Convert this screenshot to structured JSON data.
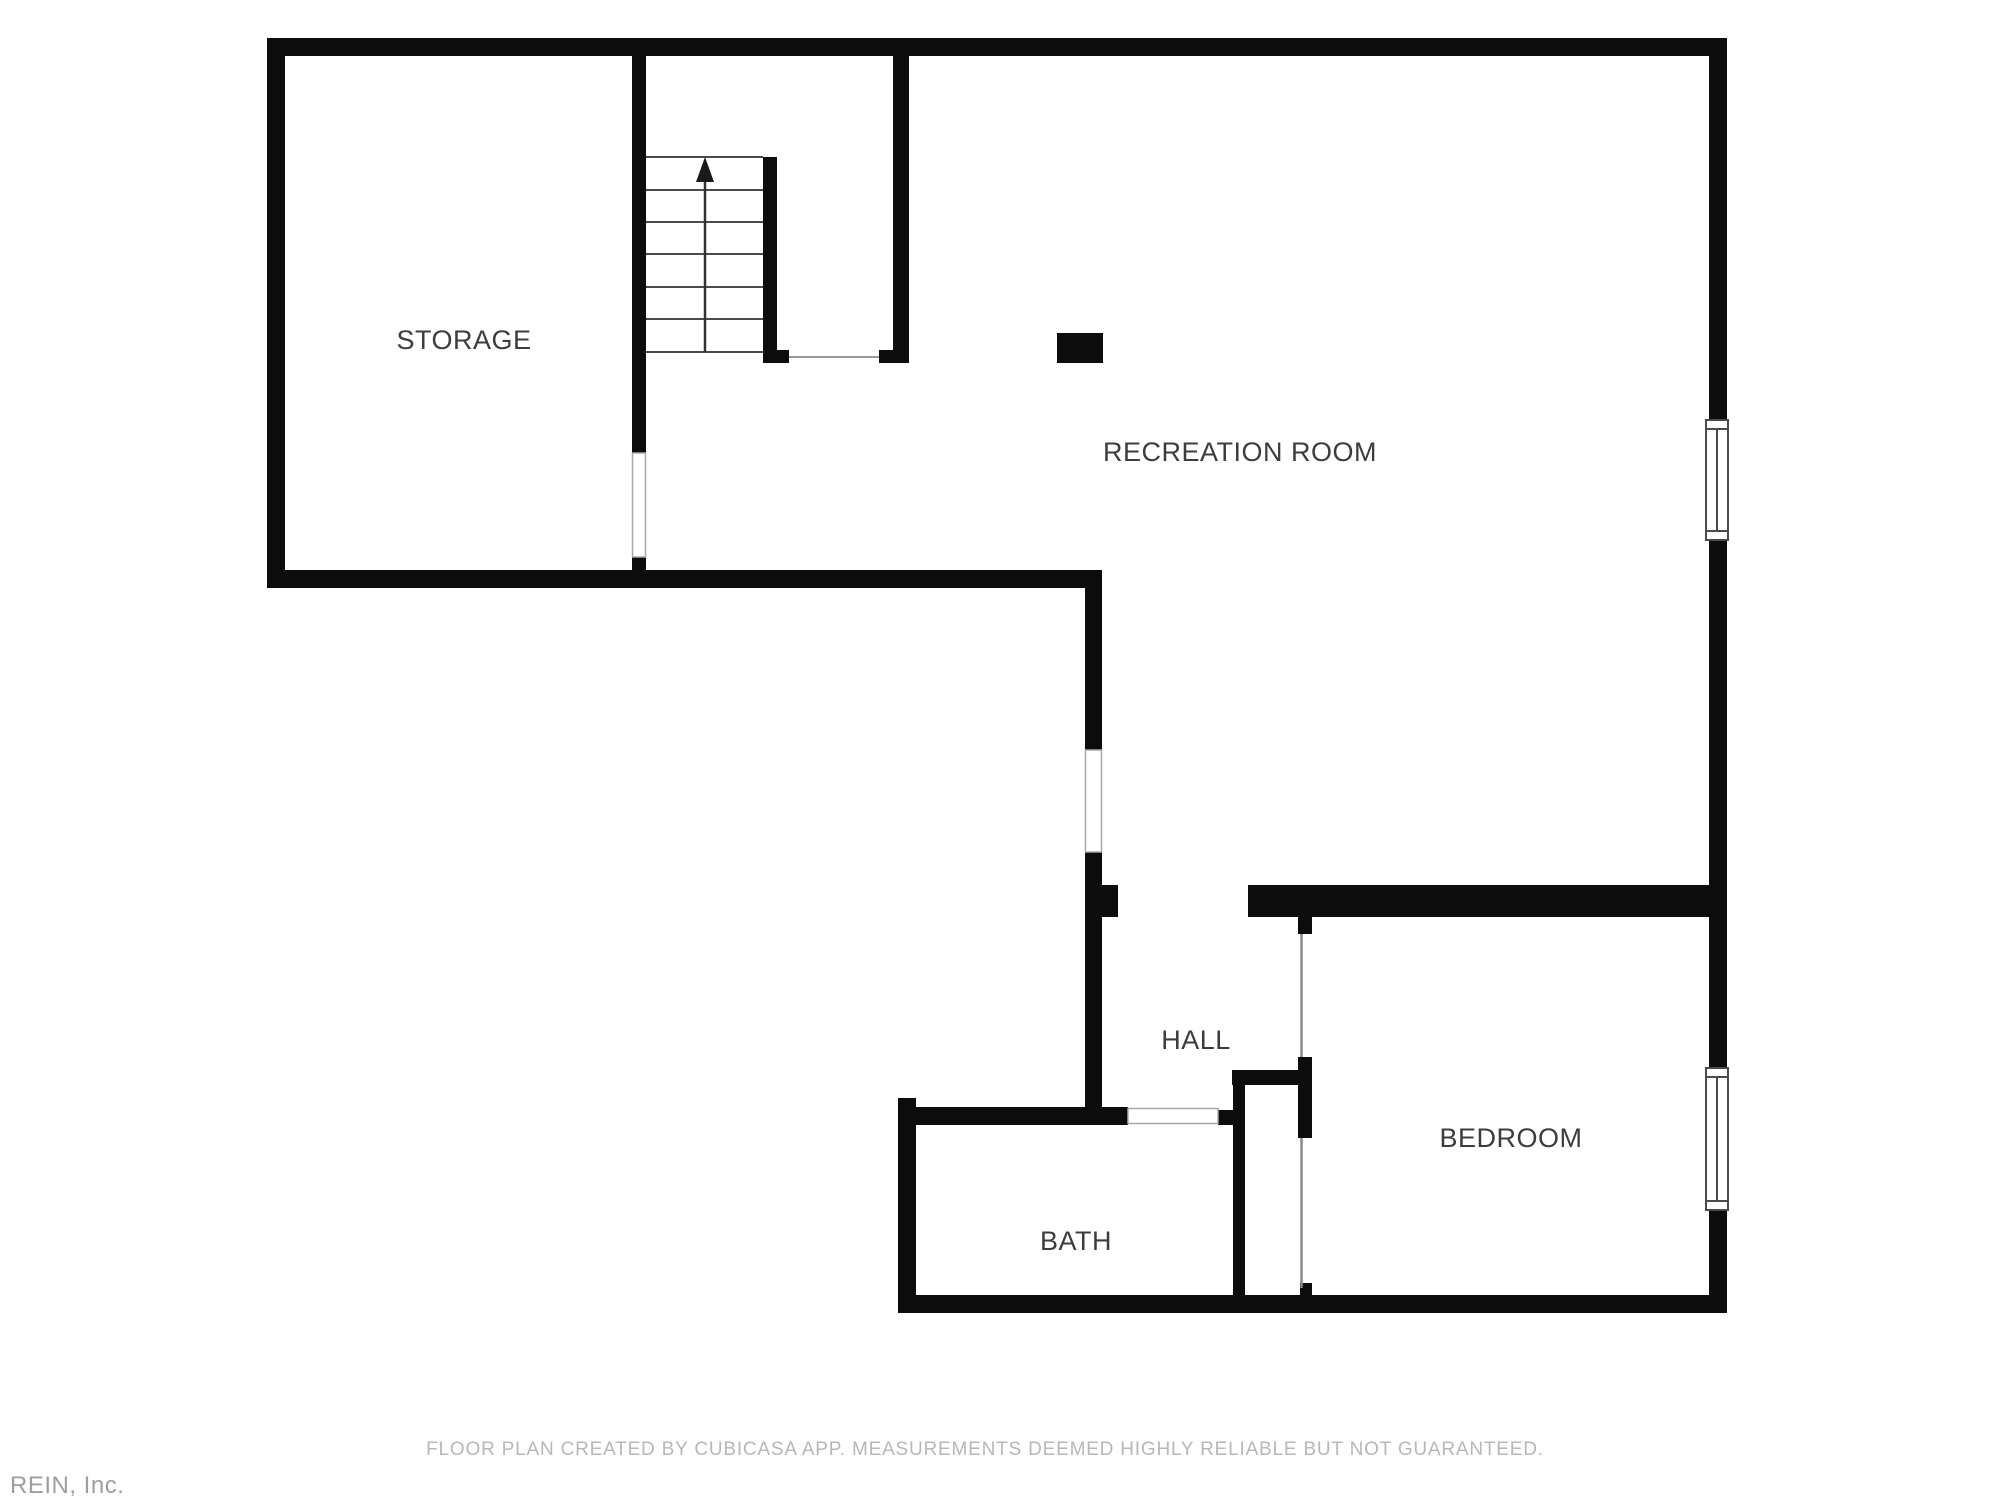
{
  "floor_plan": {
    "rooms": {
      "storage": {
        "label": "STORAGE"
      },
      "recreation_room": {
        "label": "RECREATION ROOM"
      },
      "hall": {
        "label": "HALL"
      },
      "bath": {
        "label": "BATH"
      },
      "bedroom": {
        "label": "BEDROOM"
      }
    },
    "colors": {
      "wall": "#0c0c0c",
      "room_label": "#3c3c3c",
      "stair_line": "#4a4a4a",
      "opening_line": "#a8a8a8",
      "background": "#ffffff",
      "footer_text": "#b7b7b7",
      "watermark_text": "#9e9e9e"
    }
  },
  "footer": {
    "disclaimer": "FLOOR PLAN CREATED BY CUBICASA APP. MEASUREMENTS DEEMED HIGHLY RELIABLE BUT NOT GUARANTEED."
  },
  "branding": {
    "attribution": "REIN, Inc."
  }
}
